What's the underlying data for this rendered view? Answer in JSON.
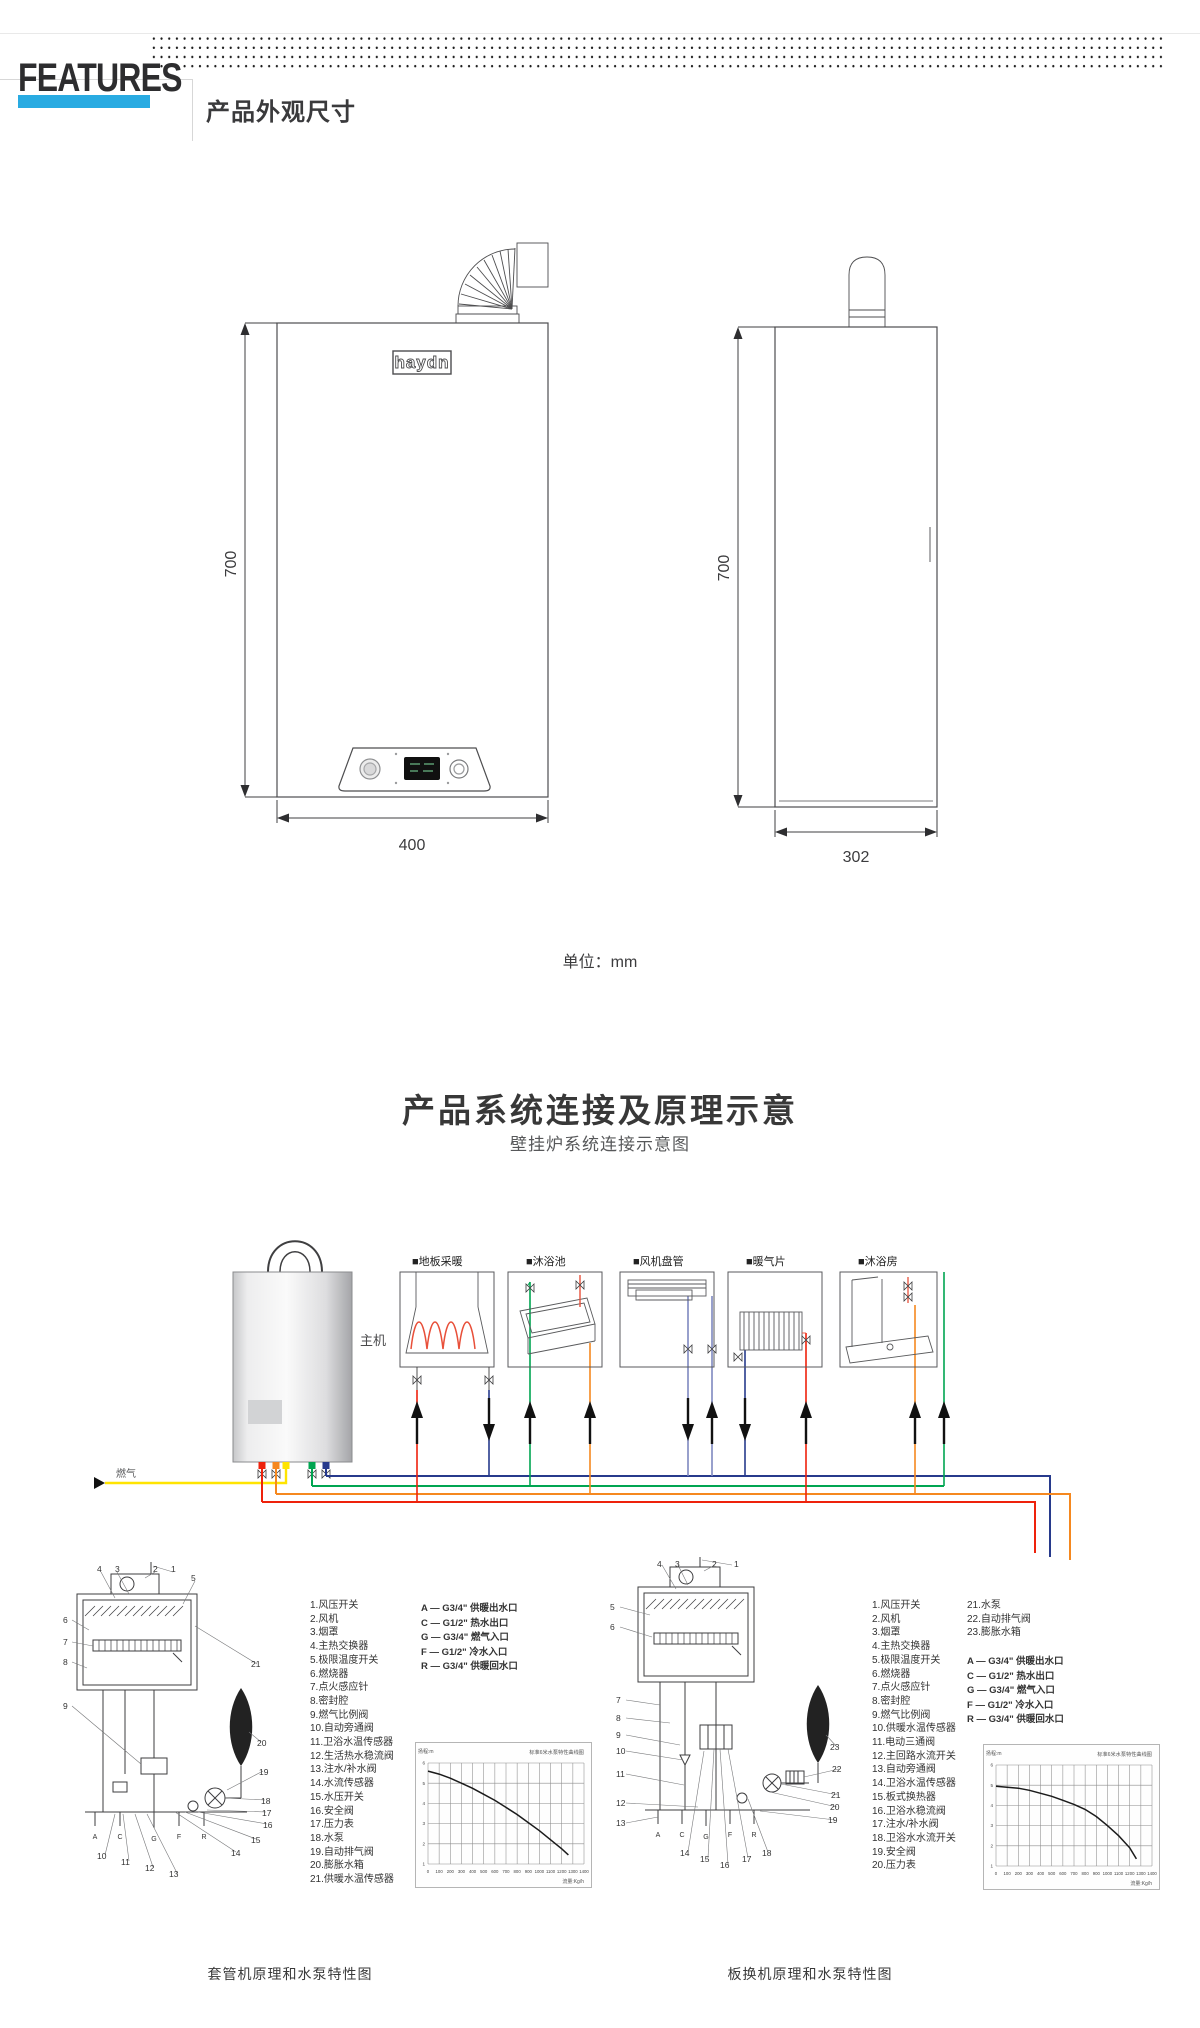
{
  "header": {
    "brand": "FEATURES",
    "section_title": "产品外观尺寸",
    "accent_color": "#29abe2"
  },
  "dims": {
    "logo": "haydn",
    "front_height": "700",
    "front_width": "400",
    "side_height": "700",
    "side_width": "302",
    "unit_note": "单位：mm"
  },
  "system": {
    "title": "产品系统连接及原理示意",
    "subtitle": "壁挂炉系统连接示意图",
    "boiler_label": "主机",
    "gas_label": "燃气",
    "terminals": [
      "■地板采暖",
      "■沐浴池",
      "■风机盘管",
      "■暖气片",
      "■沐浴房"
    ],
    "pipe_colors": {
      "red": "#ee220c",
      "orange": "#f5881f",
      "yellow": "#ffe400",
      "green": "#00a551",
      "navy": "#273a8c",
      "violet": "#7e88c0"
    }
  },
  "bottom": {
    "left": {
      "caption": "套管机原理和水泵特性图",
      "parts": [
        "1.风压开关",
        "2.风机",
        "3.烟罩",
        "4.主热交换器",
        "5.极限温度开关",
        "6.燃烧器",
        "7.点火感应针",
        "8.密封腔",
        "9.燃气比例阀",
        "10.自动旁通阀",
        "11.卫浴水温传感器",
        "12.生活热水稳流阀",
        "13.注水/补水阀",
        "14.水流传感器",
        "15.水压开关",
        "16.安全阀",
        "17.压力表",
        "18.水泵",
        "19.自动排气阀",
        "20.膨胀水箱",
        "21.供暖水温传感器"
      ],
      "connections": [
        "A — G3/4\" 供暖出水口",
        "C — G1/2\" 热水出口",
        "G — G3/4\" 燃气入口",
        "F — G1/2\" 冷水入口",
        "R — G3/4\" 供暖回水口"
      ],
      "callouts": [
        "1",
        "2",
        "3",
        "4",
        "5",
        "6",
        "7",
        "8",
        "9",
        "10",
        "11",
        "12",
        "13",
        "14",
        "15",
        "16",
        "17",
        "18",
        "19",
        "20",
        "21"
      ],
      "ports": [
        "A",
        "C",
        "G",
        "F",
        "R"
      ]
    },
    "right": {
      "caption": "板换机原理和水泵特性图",
      "parts": [
        "1.风压开关",
        "2.风机",
        "3.烟罩",
        "4.主热交换器",
        "5.极限温度开关",
        "6.燃烧器",
        "7.点火感应针",
        "8.密封腔",
        "9.燃气比例阀",
        "10.供暖水温传感器",
        "11.电动三通阀",
        "12.主回路水流开关",
        "13.自动旁通阀",
        "14.卫浴水温传感器",
        "15.板式换热器",
        "16.卫浴水稳流阀",
        "17.注水/补水阀",
        "18.卫浴水水流开关",
        "19.安全阀",
        "20.压力表"
      ],
      "parts2": [
        "21.水泵",
        "22.自动排气阀",
        "23.膨胀水箱"
      ],
      "connections": [
        "A — G3/4\" 供暖出水口",
        "C — G1/2\" 热水出口",
        "G — G3/4\" 燃气入口",
        "F — G1/2\" 冷水入口",
        "R — G3/4\" 供暖回水口"
      ],
      "callouts": [
        "1",
        "2",
        "3",
        "4",
        "5",
        "6",
        "7",
        "8",
        "9",
        "10",
        "11",
        "12",
        "13",
        "14",
        "15",
        "16",
        "17",
        "18",
        "19",
        "20",
        "21",
        "22",
        "23"
      ],
      "ports": [
        "A",
        "C",
        "G",
        "F",
        "R"
      ]
    }
  },
  "chart_data": [
    {
      "type": "line",
      "title": "标准6米水泵特性曲线图",
      "ylabel": "扬程:m",
      "xlabel": "流量:Kg/h",
      "xlim": [
        0,
        1400
      ],
      "ylim": [
        1,
        6
      ],
      "x_ticks": [
        0,
        100,
        200,
        300,
        400,
        500,
        600,
        700,
        800,
        900,
        1000,
        1100,
        1200,
        1300,
        1400
      ],
      "y_ticks": [
        1,
        2,
        3,
        4,
        5,
        6
      ],
      "grid": true,
      "legend": "none",
      "series": [
        {
          "name": "套管机水泵特性",
          "points": [
            [
              0,
              5.6
            ],
            [
              100,
              5.45
            ],
            [
              200,
              5.25
            ],
            [
              300,
              5.0
            ],
            [
              400,
              4.75
            ],
            [
              500,
              4.45
            ],
            [
              600,
              4.15
            ],
            [
              700,
              3.8
            ],
            [
              800,
              3.45
            ],
            [
              900,
              3.05
            ],
            [
              1000,
              2.65
            ],
            [
              1100,
              2.2
            ],
            [
              1200,
              1.75
            ],
            [
              1260,
              1.45
            ]
          ]
        }
      ]
    },
    {
      "type": "line",
      "title": "标准6米水泵特性曲线图",
      "ylabel": "扬程:m",
      "xlabel": "流量:Kg/h",
      "xlim": [
        0,
        1400
      ],
      "ylim": [
        1,
        6
      ],
      "x_ticks": [
        0,
        100,
        200,
        300,
        400,
        500,
        600,
        700,
        800,
        900,
        1000,
        1100,
        1200,
        1300,
        1400
      ],
      "y_ticks": [
        1,
        2,
        3,
        4,
        5,
        6
      ],
      "grid": true,
      "legend": "none",
      "series": [
        {
          "name": "板换机水泵特性",
          "points": [
            [
              0,
              4.95
            ],
            [
              100,
              4.9
            ],
            [
              200,
              4.85
            ],
            [
              300,
              4.75
            ],
            [
              400,
              4.6
            ],
            [
              500,
              4.45
            ],
            [
              600,
              4.25
            ],
            [
              700,
              4.05
            ],
            [
              800,
              3.8
            ],
            [
              900,
              3.45
            ],
            [
              1000,
              3.0
            ],
            [
              1100,
              2.5
            ],
            [
              1200,
              1.9
            ],
            [
              1260,
              1.35
            ]
          ]
        }
      ]
    }
  ]
}
